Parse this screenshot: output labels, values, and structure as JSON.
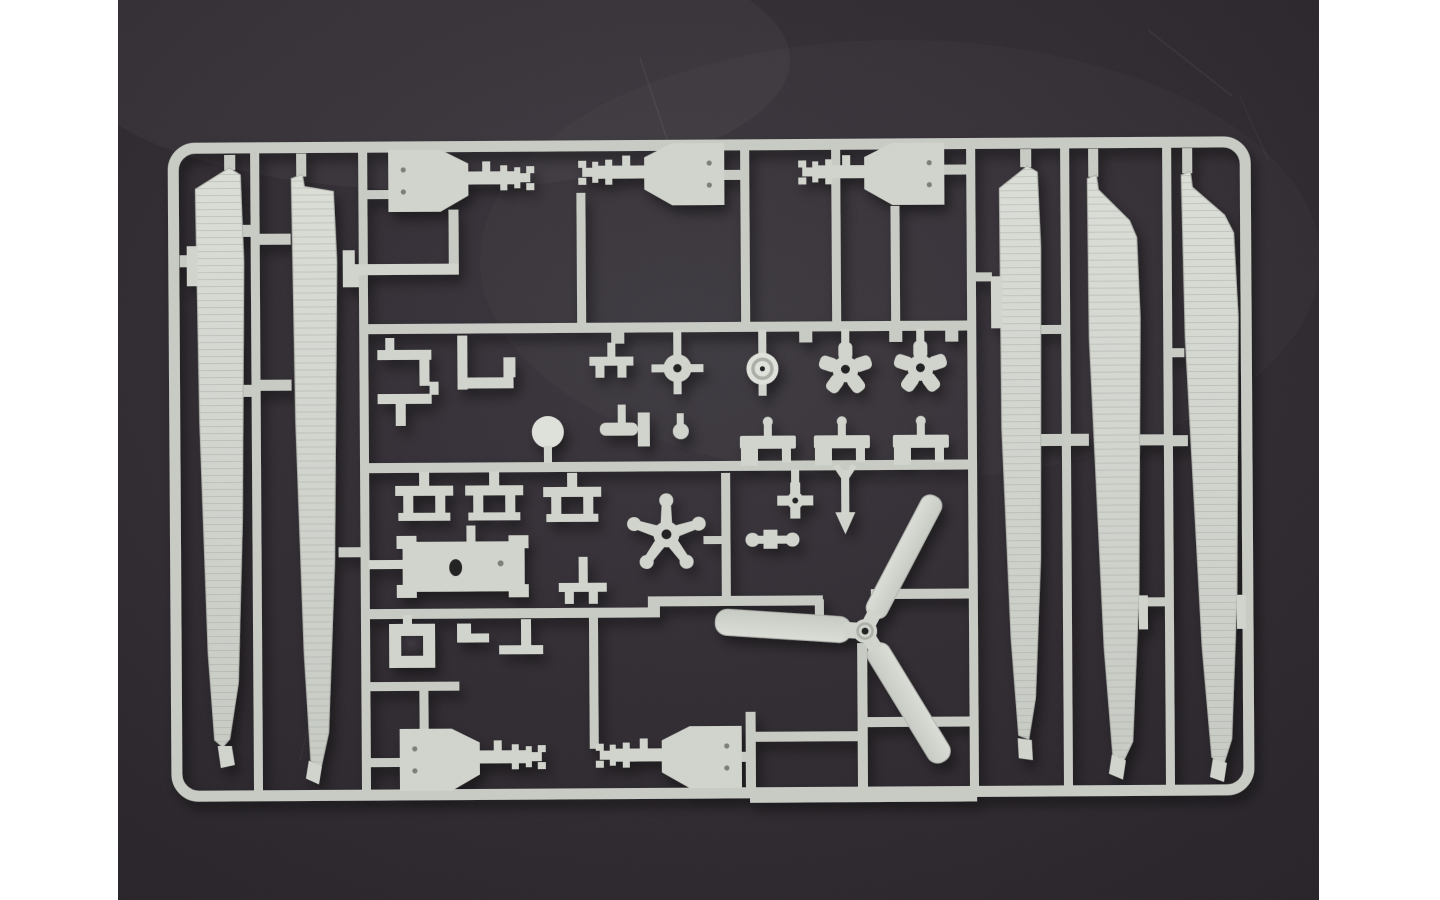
{
  "scene": {
    "caption": "Photograph of a light-grey injection-moulded model kit sprue (parts runner) with helicopter parts laid on a dark charcoal background",
    "subject": "plastic model kit sprue",
    "background_description": "dark charcoal studio surface with faint scratches and soft vignette",
    "margins_description": "plain white vertical bars on the left and right sides of the photo",
    "no_visible_text": true
  },
  "colors": {
    "page_bg": "#ffffff",
    "bg_center": "#37323a",
    "bg_mid": "#2b262c",
    "bg_edge": "#211d23",
    "rail": "#c6cac3",
    "part": "#cfd3cb",
    "bright": "#dee1da",
    "blade_top": "#daddd6",
    "blade_bottom": "#c6cac3",
    "edge": "#b0b4ad",
    "shade": "#a9ada5",
    "hole": "#1e1a1e",
    "dot": "#787c74"
  },
  "sprue": {
    "material": "light grey styrene",
    "parts": [
      {
        "id": "main-rotor-blade-left",
        "label": "long main rotor blade (left group)",
        "qty": 2
      },
      {
        "id": "main-rotor-blade-right",
        "label": "long main rotor blade (right group)",
        "qty": 3
      },
      {
        "id": "tail-rotor",
        "label": "three-blade tail rotor",
        "qty": 1
      },
      {
        "id": "machine-gun",
        "label": "machine gun half with barrel and muzzle",
        "qty": 4
      },
      {
        "id": "wheel-hub",
        "label": "small wheel / hub with stubs",
        "qty": 2
      },
      {
        "id": "star-gear",
        "label": "five-lobed star gear",
        "qty": 2
      },
      {
        "id": "rotor-spider",
        "label": "five-armed rotor spider",
        "qty": 1
      },
      {
        "id": "gearbox-plate",
        "label": "rectangular gearbox plate with oval hole",
        "qty": 1
      },
      {
        "id": "dome-ball",
        "label": "small dome / ball fitting",
        "qty": 1
      },
      {
        "id": "cross-fitting",
        "label": "cross-shaped swashplate fitting",
        "qty": 1
      },
      {
        "id": "dart-fitting",
        "label": "dart-shaped linkage fitting",
        "qty": 1
      },
      {
        "id": "mount-bracket",
        "label": "small mounting bracket / clamp",
        "qty": 12
      },
      {
        "id": "box-mount",
        "label": "box mount with locating pin",
        "qty": 3
      },
      {
        "id": "frame-square",
        "label": "small open square frame",
        "qty": 1
      }
    ]
  }
}
